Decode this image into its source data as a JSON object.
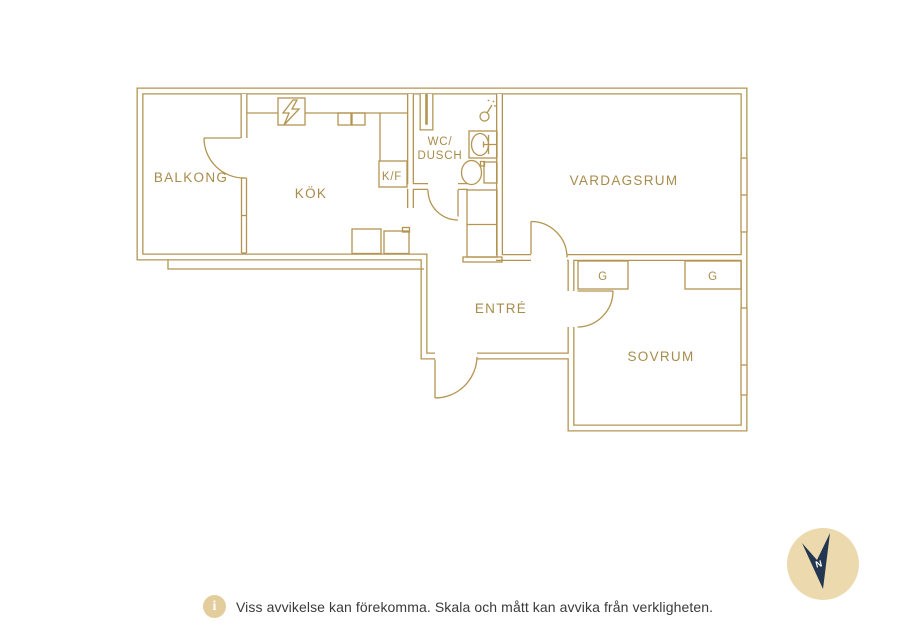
{
  "floorplan": {
    "rooms": {
      "balkong": {
        "label": "BALKONG"
      },
      "kok": {
        "label": "KÖK"
      },
      "kf": {
        "label": "K/F"
      },
      "wc": {
        "label_line1": "WC/",
        "label_line2": "DUSCH"
      },
      "vardagsrum": {
        "label": "VARDAGSRUM"
      },
      "entre": {
        "label": "ENTRÉ"
      },
      "sovrum": {
        "label": "SOVRUM"
      },
      "garderob1": {
        "label": "G"
      },
      "garderob2": {
        "label": "G"
      }
    },
    "icons": [
      "lightning-icon",
      "shower-icon",
      "sink-icon",
      "toilet-icon",
      "compass-icon",
      "info-icon"
    ],
    "compass": {
      "north_label": "N"
    },
    "colors": {
      "line_gold": "#b39451",
      "label_gold": "#a78c4b",
      "compass_navy": "#233850",
      "compass_beige": "#ecdaae",
      "info_tan": "#e4cd9d",
      "footer_text": "#3a3a3a",
      "background": "#ffffff"
    }
  },
  "footer": {
    "info_icon": "i",
    "disclaimer": "Viss avvikelse kan förekomma. Skala och mått kan avvika från verkligheten."
  }
}
